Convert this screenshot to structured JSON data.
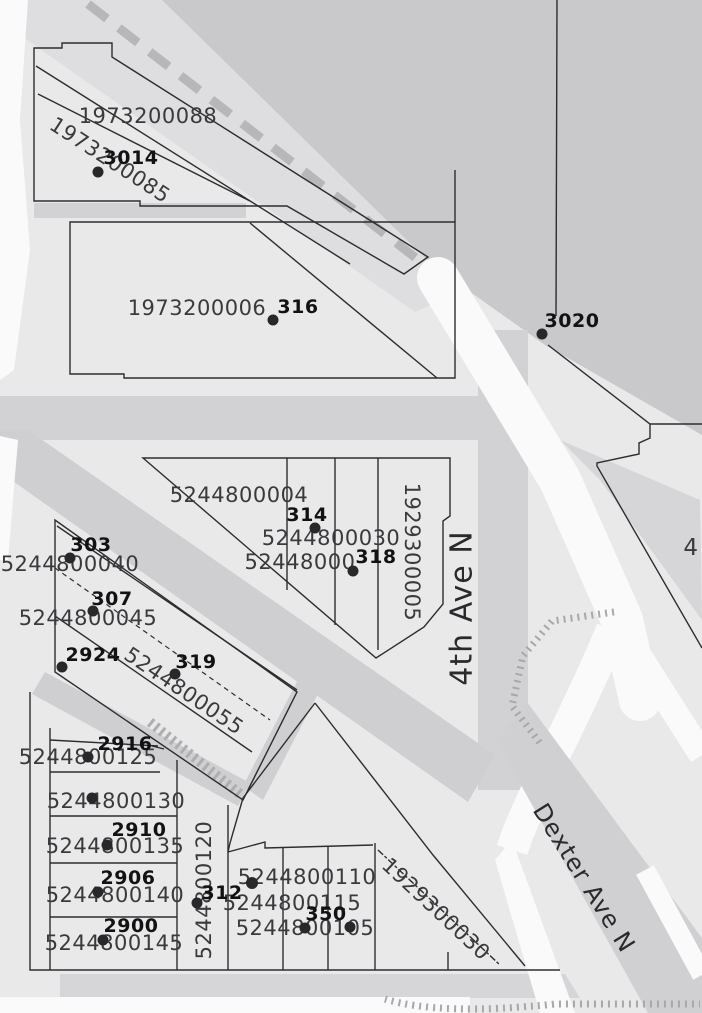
{
  "map": {
    "streets": {
      "fourth_ave_n": "4th Ave N",
      "dexter_ave_n": "Dexter Ave N"
    },
    "addresses": {
      "a3014": "3014",
      "a316": "316",
      "a3020": "3020",
      "a314": "314",
      "a318": "318",
      "a303": "303",
      "a307": "307",
      "a2924": "2924",
      "a319": "319",
      "a2916": "2916",
      "a2910": "2910",
      "a2906": "2906",
      "a2900": "2900",
      "a312": "312",
      "a350": "350"
    },
    "parcels": {
      "p1973200088": "1973200088",
      "p1973200085": "1973200085",
      "p1973200006": "1973200006",
      "p5244800004": "5244800004",
      "p5244800030": "5244800030",
      "p52448000xx": "52448000",
      "p1929300005": "1929300005",
      "p5244800040": "5244800040",
      "p5244800045": "5244800045",
      "p5244800055": "5244800055",
      "p5244800125": "5244800125",
      "p5244800130": "5244800130",
      "p5244800135": "5244800135",
      "p5244800120": "5244800120",
      "p5244800140": "5244800140",
      "p5244800145": "5244800145",
      "p5244800110": "5244800110",
      "p5244800115": "5244800115",
      "p5244800105": "5244800105",
      "p1929300030": "1929300030"
    },
    "partial_labels": {
      "right_edge": "4"
    },
    "colors": {
      "paper": "#e9e9ea",
      "shade": "#c9c9cc",
      "road": "#d2d2d4",
      "white_road": "#fafafa",
      "parcel_line": "#2d2d30",
      "parcel_label": "#3a3a3d",
      "address_label": "#121214"
    }
  }
}
